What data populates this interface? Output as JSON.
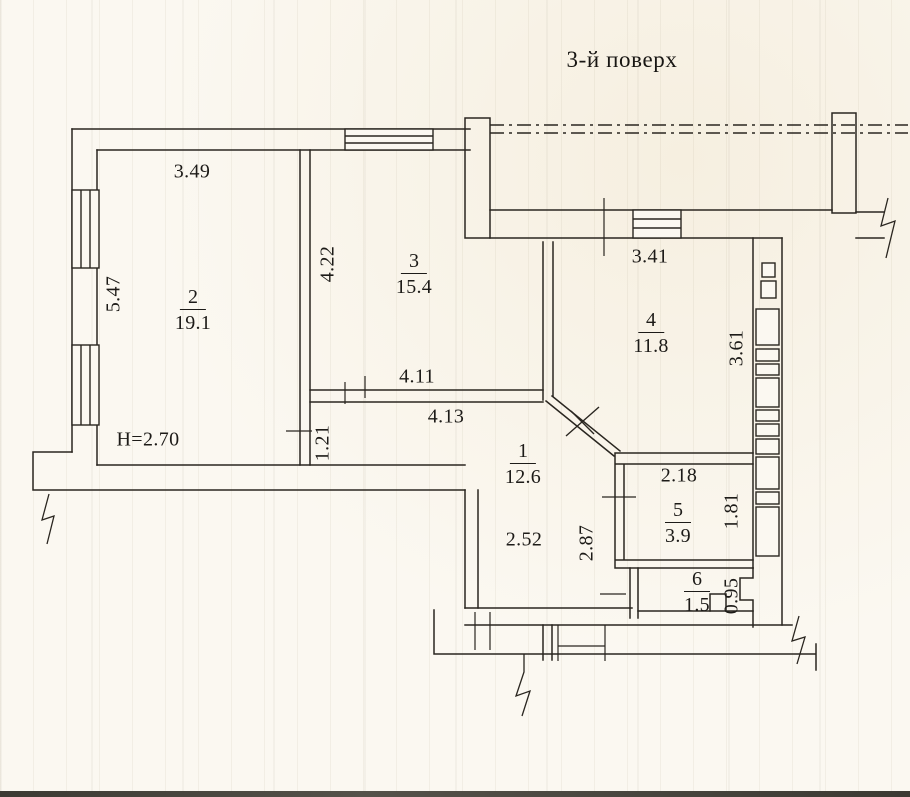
{
  "title": "3-й поверх",
  "height_note": "H=2.70",
  "rooms": [
    {
      "number": "1",
      "area": "12.6"
    },
    {
      "number": "2",
      "area": "19.1"
    },
    {
      "number": "3",
      "area": "15.4"
    },
    {
      "number": "4",
      "area": "11.8"
    },
    {
      "number": "5",
      "area": "3.9"
    },
    {
      "number": "6",
      "area": "1.5"
    }
  ],
  "dimensions": {
    "room2_width": "3.49",
    "room2_depth": "5.47",
    "room3_depth": "4.22",
    "room4_width": "3.41",
    "shaft_height": "3.61",
    "hall_top_upper": "4.11",
    "hall_top_lower": "4.13",
    "hall_left_jog": "1.21",
    "room5_width": "2.18",
    "room5_depth": "1.81",
    "hall_width": "2.52",
    "hall_depth": "2.87",
    "niche_width": "0.95"
  },
  "colors": {
    "paper": "#fbf8f1",
    "ink": "#25221d"
  }
}
